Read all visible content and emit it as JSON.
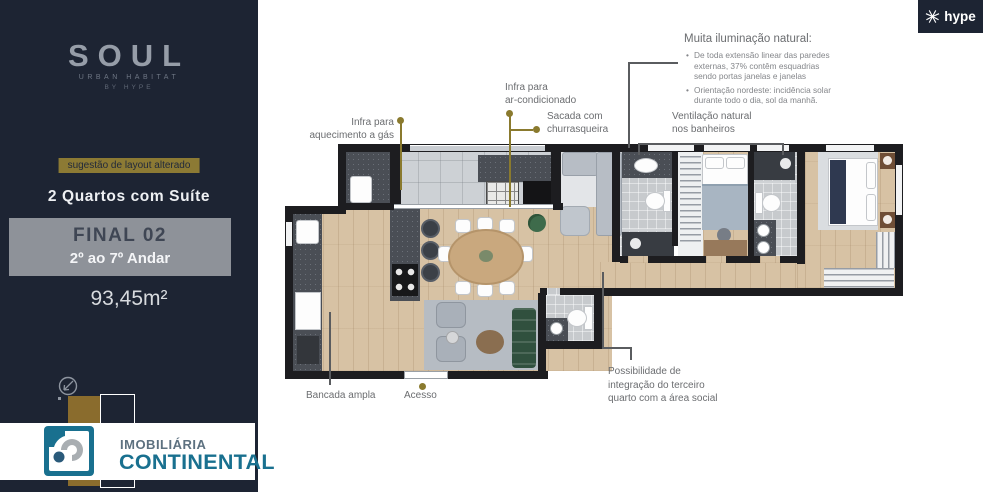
{
  "brand": {
    "hype_logo": "hype",
    "realtor_top": "IMOBILIÁRIA",
    "realtor_bottom": "CONTINENTAL"
  },
  "sidebar": {
    "logo_title": "SOUL",
    "logo_subtitle": "URBAN HABITAT",
    "logo_byline": "BY HYPE",
    "badge": "sugestão de layout alterado",
    "unit_type": "2 Quartos com Suíte",
    "unit_number": "FINAL 02",
    "floors": "2º ao 7º Andar",
    "area": "93,45m²"
  },
  "notes": {
    "lighting_title": "Muita iluminação natural:",
    "lighting_bullets": [
      "De toda extensão linear das paredes externas, 37% contêm esquadrias sendo portas janelas e janelas",
      "Orientação nordeste: incidência solar durante todo o dia, sol da manhã."
    ]
  },
  "callouts": {
    "gas": "Infra para\naquecimento a gás",
    "ac": "Infra para\nar-condicionado",
    "bbq": "Sacada com\nchurrasqueira",
    "vent": "Ventilação natural\nnos banheiros",
    "counter": "Bancada ampla",
    "entry": "Acesso",
    "integration": "Possibilidade de\nintegração do terceiro\nquarto com a área social"
  },
  "colors": {
    "sidebar_bg": "#1d2433",
    "accent_gold": "#8a7a2e",
    "badge_bg": "#8c7a34",
    "realtor_teal": "#19708f",
    "wall": "#1d1d20",
    "wood_floor": "#d7c2a4",
    "counter_granite": "#4a4e55",
    "sofa_green": "#30503e"
  }
}
